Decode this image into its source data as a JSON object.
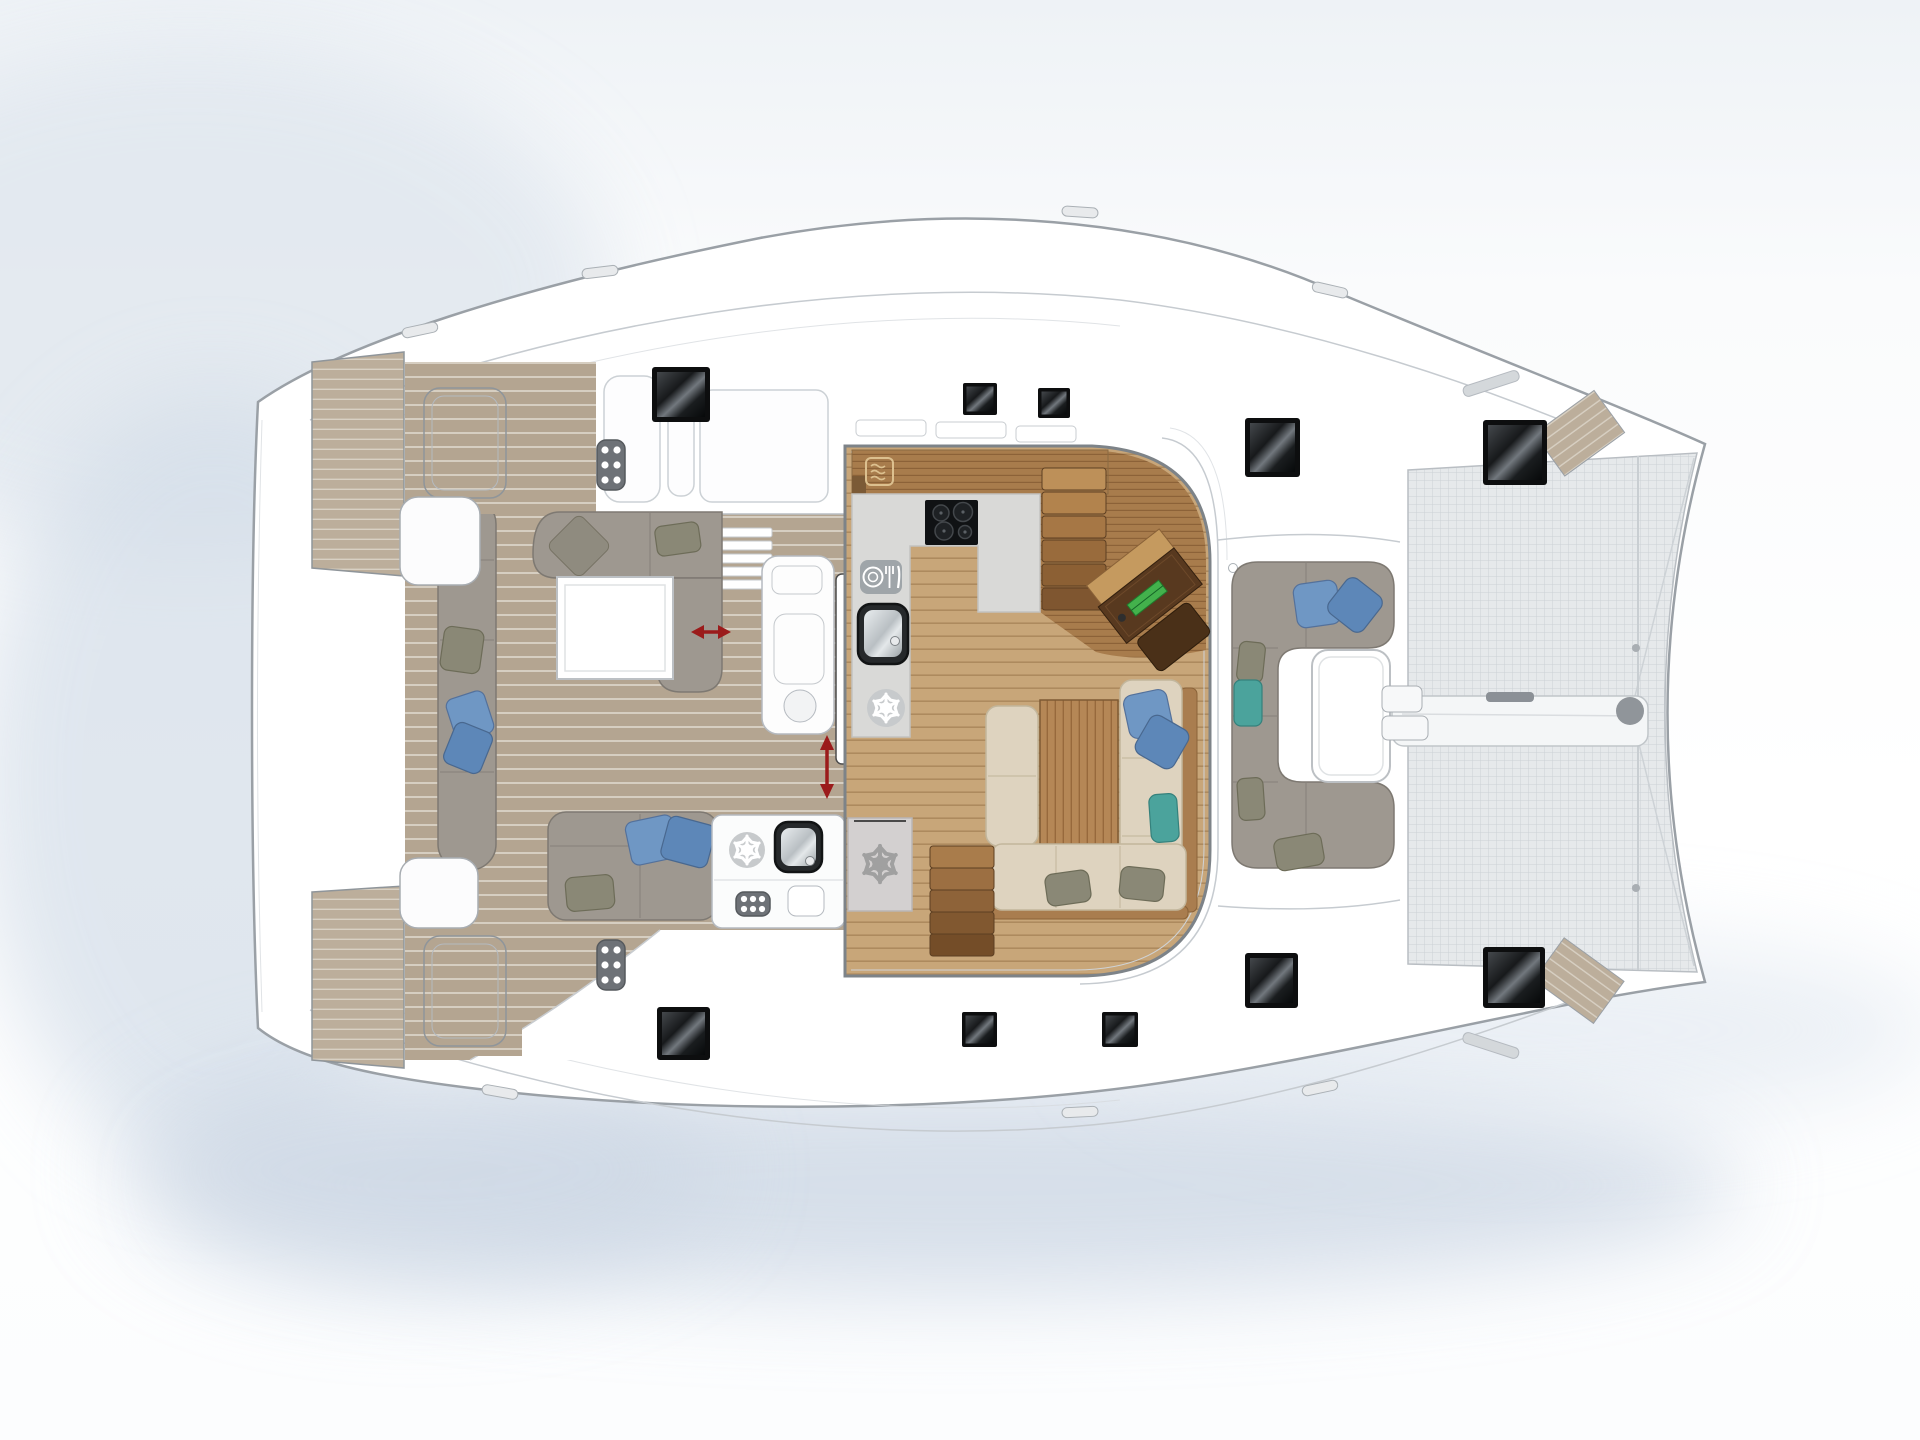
{
  "document": {
    "kind": "boat-floor-plan",
    "subject": "catamaran main deck layout, top view, bows to the right",
    "visible_text": "none"
  },
  "palette": {
    "hull_outline": "#9aa0a6",
    "deck_white": "#ffffff",
    "floor_teak_grey": "#b4a591",
    "floor_teak_line": "#d6cec1",
    "floor_wood": "#c8a679",
    "floor_wood_line": "#ad8a5e",
    "counter_wood": "#a87c4c",
    "counter_grey": "#d9d9d7",
    "sofa_grey": "#9e9890",
    "sofa_beige": "#ded3bf",
    "pillow_blue": "#6f97c4",
    "pillow_blue_dark": "#5d87b8",
    "pillow_teal": "#4ba39c",
    "pillow_olive": "#8a8876",
    "table_white": "#ffffff",
    "hatch_black": "#0d0e0f",
    "arrow_red": "#9b1b1b",
    "trampoline": "#e6e9eb",
    "speaker_grey": "#6e7277",
    "icon_grey": "#c7cacc",
    "desk_wood_dark": "#58391f",
    "radio_green": "#43b14c"
  },
  "icons": [
    {
      "name": "snowflake-icon",
      "meaning": "refrigerator / freezer position",
      "count": 3
    },
    {
      "name": "microwave-icon",
      "meaning": "microwave oven in galley",
      "count": 1
    },
    {
      "name": "dishwasher-icon",
      "meaning": "dishwasher (plate, fork, knife)",
      "count": 1
    },
    {
      "name": "stove-icon",
      "meaning": "4-burner cooktop",
      "count": 1
    },
    {
      "name": "sink-icon",
      "meaning": "sink basin",
      "count": 2
    },
    {
      "name": "speaker-icon",
      "meaning": "cockpit loudspeaker grille",
      "count": 3
    },
    {
      "name": "hatch-skylight-icon",
      "meaning": "black deck hatch / skylight",
      "count": 10
    },
    {
      "name": "slide-arrow-icon",
      "meaning": "sliding element direction (red double arrow)",
      "count": 2
    }
  ],
  "areas": [
    {
      "name": "stern-platforms",
      "features": [
        "teak swim platform port",
        "teak swim platform starboard",
        "engine hatches"
      ]
    },
    {
      "name": "aft-cockpit",
      "features": [
        "L-shaped lounge sofa with sliding chaise",
        "white coffee table",
        "side bench with pillows",
        "aft bench with pillows",
        "wet bar with sink and fridge",
        "sliding door to saloon"
      ]
    },
    {
      "name": "saloon-galley",
      "features": [
        "U-shaped galley with cooktop, sink, dishwasher, fridge",
        "microwave shelf",
        "stairs to starboard hull",
        "stairs to port hull",
        "chart table with seat and radio",
        "dining table with L-shaped bench",
        "freezer locker"
      ]
    },
    {
      "name": "forward-cockpit",
      "features": [
        "C-shaped sofa with pillows",
        "white table",
        "mast-base lockers"
      ]
    },
    {
      "name": "bow-area",
      "features": [
        "trampoline net",
        "forward crossbeam with furler",
        "bow step pads",
        "bow deck hatches"
      ]
    }
  ]
}
